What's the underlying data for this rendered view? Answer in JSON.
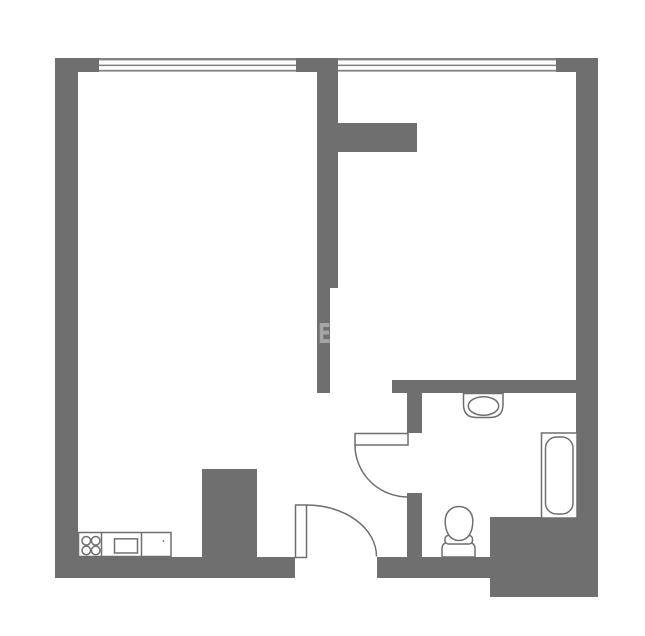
{
  "colors": {
    "background": "#ffffff",
    "wall": "#6f6f6f",
    "window_line": "#828282",
    "fixture": "#6f6f6f",
    "watermark": "rgba(255,255,255,0.38)"
  },
  "watermark": {
    "text": "E"
  },
  "plan": {
    "type": "floor-plan",
    "fixture_symbols": [
      "window-top-left",
      "window-top-right",
      "cooker-hob",
      "oven",
      "kitchen-counter",
      "wash-basin",
      "bathtub",
      "toilet",
      "entry-door-swing",
      "bathroom-door-swing"
    ]
  }
}
